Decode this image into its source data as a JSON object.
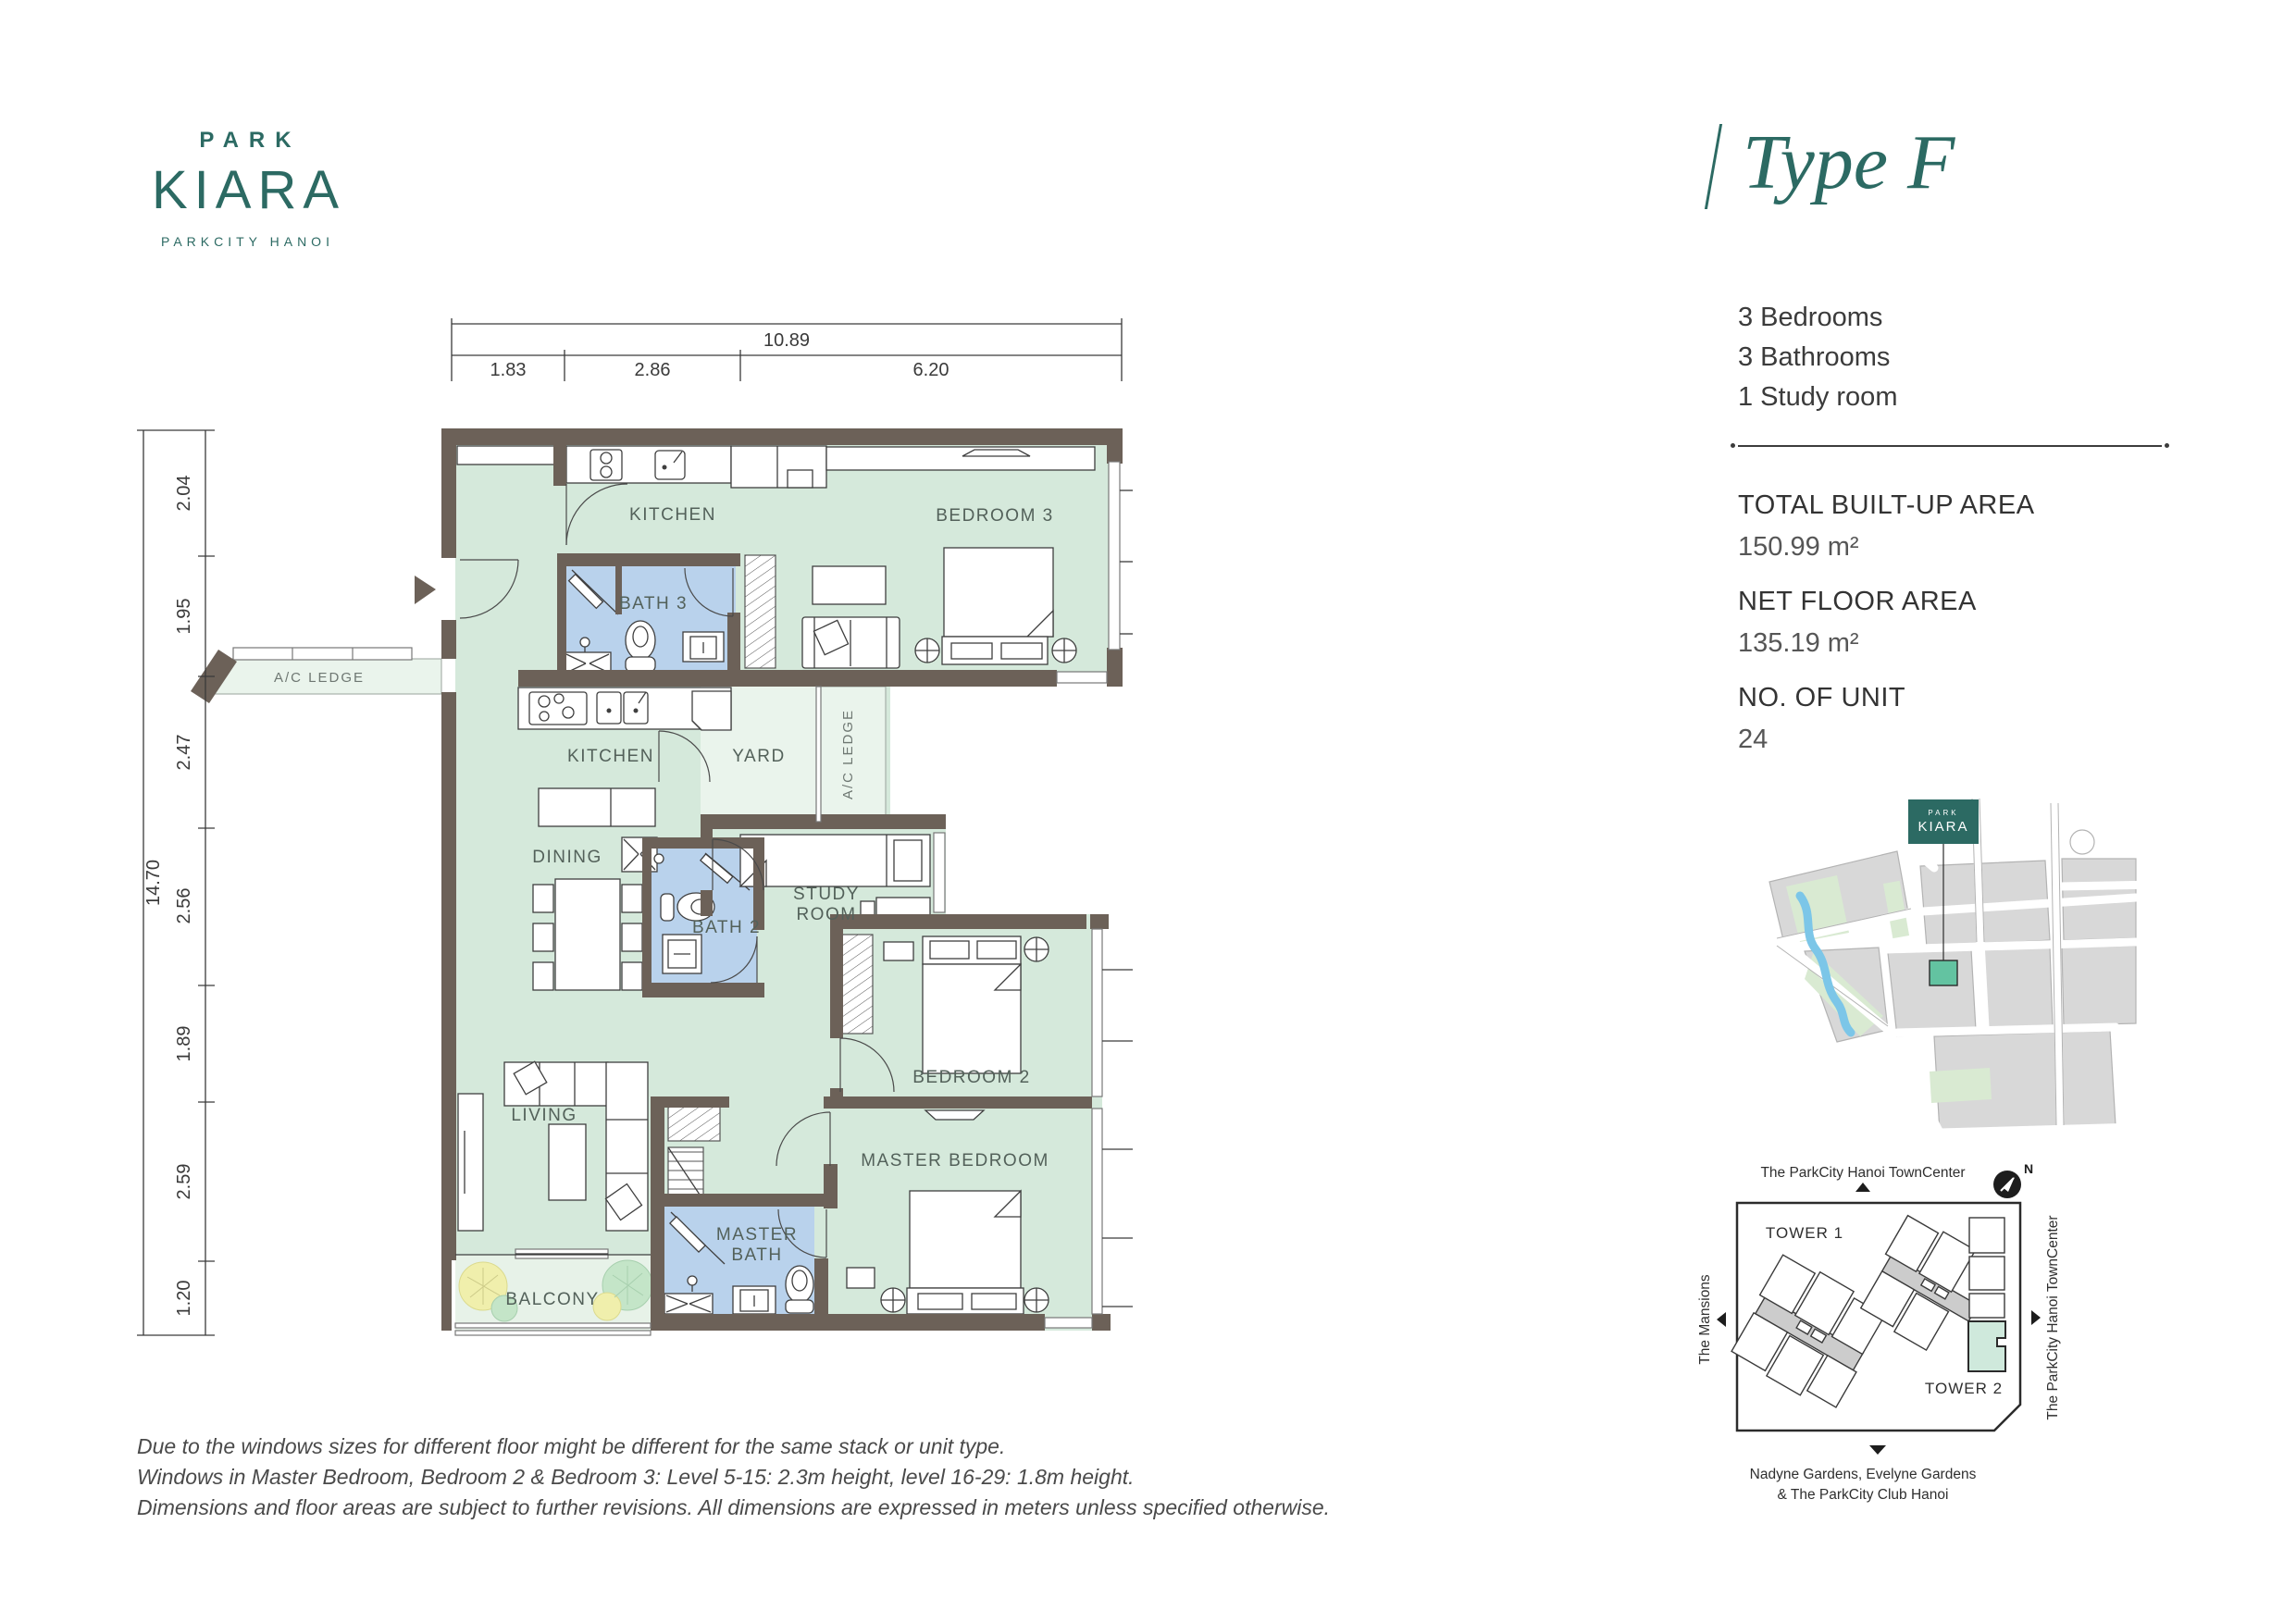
{
  "brand": {
    "top": "PARK",
    "name": "KIARA",
    "sub": "PARKCITY HANOI"
  },
  "header": {
    "title": "Type F"
  },
  "summary": {
    "items": [
      "3 Bedrooms",
      "3 Bathrooms",
      "1 Study room"
    ]
  },
  "stats": {
    "rows": [
      {
        "label": "TOTAL BUILT-UP AREA",
        "value": "150.99 m²"
      },
      {
        "label": "NET FLOOR AREA",
        "value": "135.19 m²"
      },
      {
        "label": "NO. OF UNIT",
        "value": "24"
      }
    ]
  },
  "floorplan": {
    "dims": {
      "top_total": "10.89",
      "top_segs": [
        "1.83",
        "2.86",
        "6.20"
      ],
      "left_total": "14.70",
      "left_segs": [
        "2.04",
        "1.95",
        "2.47",
        "2.56",
        "1.89",
        "2.59",
        "1.20"
      ]
    },
    "rooms": {
      "kitchen_top": "KITCHEN",
      "bedroom3": "BEDROOM 3",
      "bath3": "BATH 3",
      "ac_ledge_left": "A/C LEDGE",
      "kitchen_mid": "KITCHEN",
      "yard": "YARD",
      "ac_ledge_right": "A/C LEDGE",
      "dining": "DINING",
      "bath2": "BATH 2",
      "study1": "STUDY",
      "study2": "ROOM",
      "bedroom2": "BEDROOM 2",
      "living": "LIVING",
      "master_bedroom": "MASTER BEDROOM",
      "master_bath1": "MASTER",
      "master_bath2": "BATH",
      "balcony": "BALCONY"
    }
  },
  "site_map": {
    "logo_top": "PARK",
    "logo_name": "KIARA"
  },
  "tower_map": {
    "north": "N",
    "top_label": "The ParkCity Hanoi TownCenter",
    "right_label": "The ParkCity Hanoi TownCenter",
    "left_label": "The Mansions",
    "tower1": "TOWER 1",
    "tower2": "TOWER 2",
    "bottom_line1": "Nadyne Gardens, Evelyne Gardens",
    "bottom_line2": "& The ParkCity Club Hanoi"
  },
  "disclaimer": {
    "lines": [
      "Due to the windows sizes for different floor might be different for the same stack or unit type.",
      "Windows in Master Bedroom, Bedroom 2 & Bedroom 3: Level 5-15: 2.3m height, level 16-29: 1.8m height.",
      "Dimensions and floor areas are subject to further revisions. All dimensions are expressed in meters unless specified otherwise."
    ]
  },
  "colors": {
    "brand_teal": "#2c6a63",
    "room_mint": "#d5e9db",
    "bath_blue": "#b9d2ec",
    "service_pale": "#eaf4ec",
    "wall": "#6c6158",
    "map_lot": "#63c3a1"
  }
}
